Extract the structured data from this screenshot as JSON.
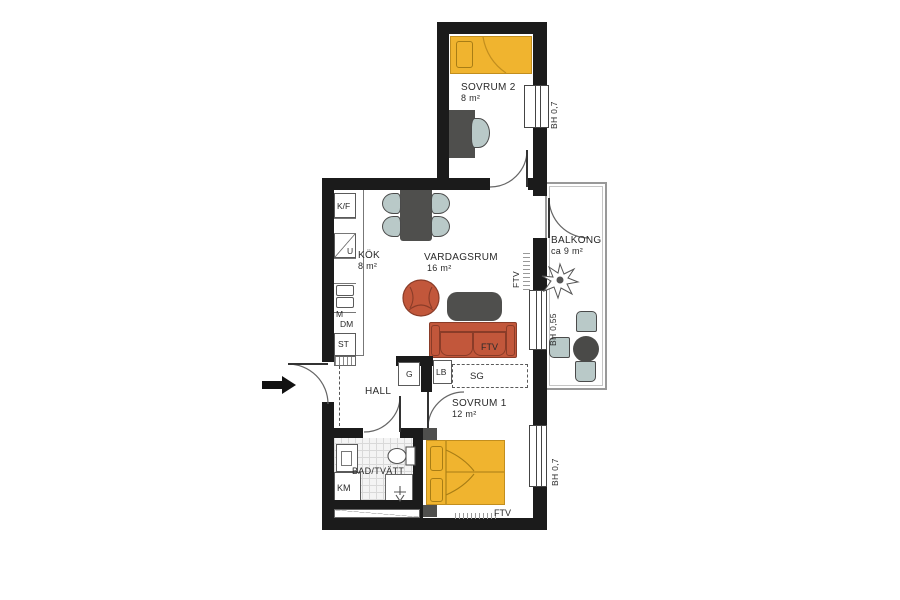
{
  "rooms": {
    "sovrum2": {
      "name": "SOVRUM 2",
      "area": "8 m²"
    },
    "kok": {
      "name": "KÖK",
      "area": "8 m²"
    },
    "vardagsrum": {
      "name": "VARDAGSRUM",
      "area": "16 m²"
    },
    "balkong": {
      "name": "BALKONG",
      "area": "ca 9 m²"
    },
    "hall": {
      "name": "HALL"
    },
    "sovrum1": {
      "name": "SOVRUM 1",
      "area": "12 m²"
    },
    "bad": {
      "name": "BAD/TVÄTT"
    }
  },
  "fixtures": {
    "kf": "K/F",
    "u": "U",
    "m": "M",
    "dm": "DM",
    "st": "ST",
    "g": "G",
    "lb": "LB",
    "sg": "SG",
    "km": "KM"
  },
  "window_labels": {
    "sovrum2": "BH 0,7",
    "vardagsrum": "BH 0,55",
    "sovrum1": "BH 0,7"
  },
  "vent_labels": {
    "wall": "FTV",
    "sofa": "FTV",
    "sovrum1": "FTV"
  },
  "colors": {
    "wall": "#1b1b1b",
    "bed_yellow": "#f0b42f",
    "terracotta": "#c2573b",
    "chair_gray": "#b9c9c8",
    "furniture_dark": "#4f4f4d"
  }
}
